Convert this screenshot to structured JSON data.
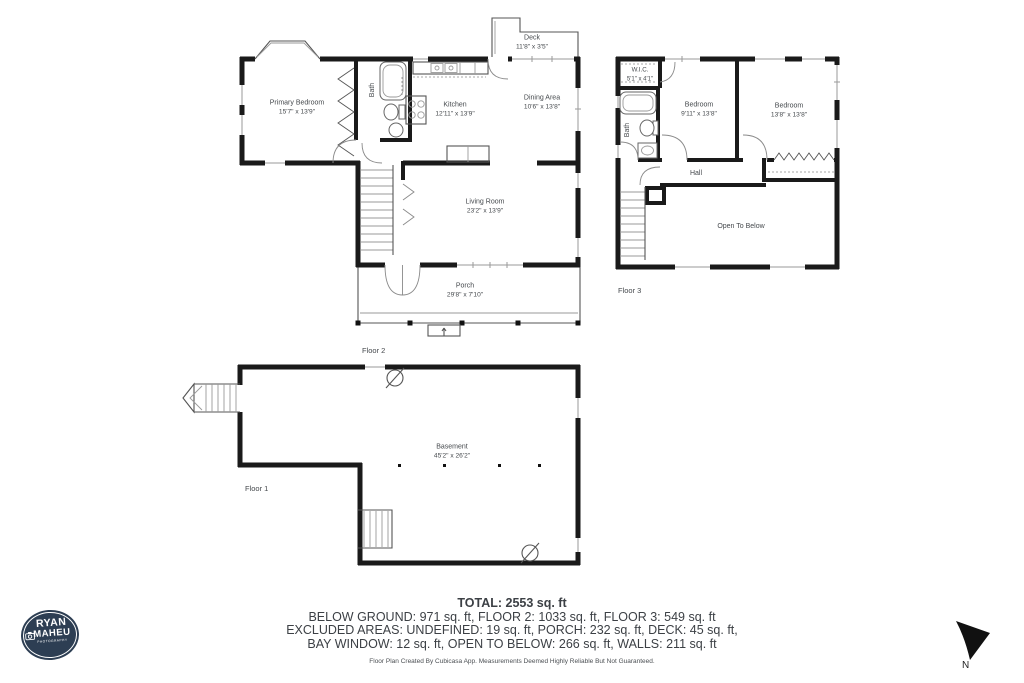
{
  "floor2": {
    "label": "Floor 2",
    "rooms": {
      "primary_bedroom": {
        "name": "Primary Bedroom",
        "dims": "15'7\" x 13'9\""
      },
      "bath": {
        "name": "Bath"
      },
      "kitchen": {
        "name": "Kitchen",
        "dims": "12'11\" x 13'9\""
      },
      "dining": {
        "name": "Dining Area",
        "dims": "10'6\" x 13'8\""
      },
      "deck": {
        "name": "Deck",
        "dims": "11'8\" x 3'5\""
      },
      "living": {
        "name": "Living Room",
        "dims": "23'2\" x 13'9\""
      },
      "porch": {
        "name": "Porch",
        "dims": "29'8\" x 7'10\""
      }
    }
  },
  "floor3": {
    "label": "Floor 3",
    "rooms": {
      "wic": {
        "name": "W.I.C.",
        "dims": "5'1\" x 4'1\""
      },
      "bath": {
        "name": "Bath"
      },
      "bedroom1": {
        "name": "Bedroom",
        "dims": "9'11\" x 13'8\""
      },
      "bedroom2": {
        "name": "Bedroom",
        "dims": "13'8\" x 13'8\""
      },
      "hall": {
        "name": "Hall"
      },
      "open_below": {
        "name": "Open To Below"
      }
    }
  },
  "floor1": {
    "label": "Floor 1",
    "rooms": {
      "basement": {
        "name": "Basement",
        "dims": "45'2\" x 26'2\""
      }
    }
  },
  "summary": {
    "total": "TOTAL: 2553 sq. ft",
    "line2": "BELOW GROUND: 971 sq. ft, FLOOR 2: 1033 sq. ft, FLOOR 3: 549 sq. ft",
    "line3": "EXCLUDED AREAS: UNDEFINED: 19 sq. ft, PORCH: 232 sq. ft, DECK: 45 sq. ft,",
    "line4": "BAY WINDOW: 12 sq. ft, OPEN TO BELOW: 266 sq. ft, WALLS: 211 sq. ft",
    "disclaimer": "Floor Plan Created By Cubicasa App. Measurements Deemed Highly Reliable But Not Guaranteed."
  },
  "logo": {
    "line1": "RYAN",
    "line2": "MAHEU",
    "line3": "PHOTOGRAPHY"
  },
  "compass": {
    "label": "N"
  },
  "colors": {
    "wall": "#1a1a1a",
    "label_text": "#45494d",
    "logo_navy": "#2d3e53"
  }
}
